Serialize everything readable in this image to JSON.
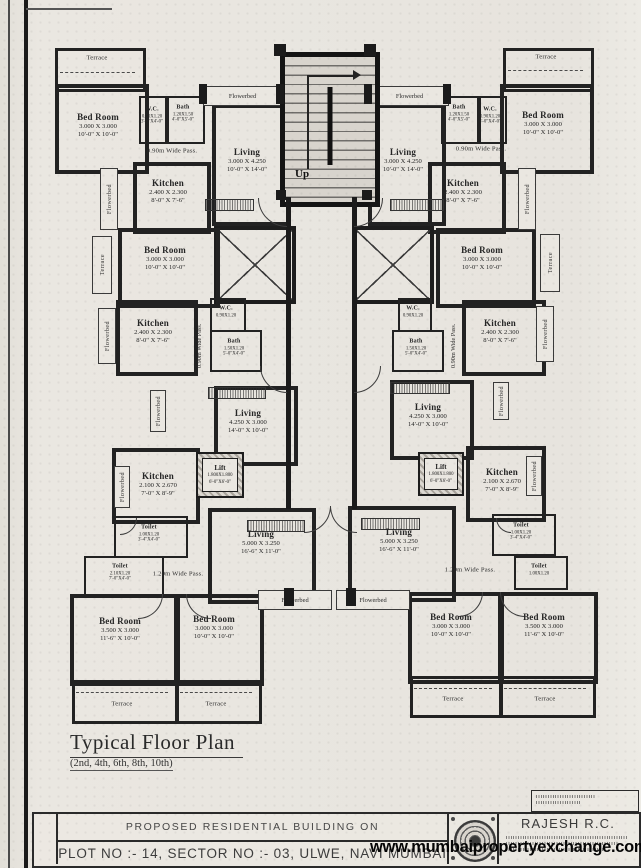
{
  "plan": {
    "title": "Typical Floor Plan",
    "subtitle": "(2nd, 4th, 6th, 8th, 10th)",
    "up": "Up",
    "labels": {
      "terrace": "Terrace",
      "flowerbed": "Flowerbed",
      "pass090": "0.90m Wide Pass.",
      "pass120": "1.20m Wide Pass."
    },
    "rooms": {
      "bed10": {
        "name": "Bed Room",
        "m": "3.000 X 3.000",
        "ft": "10'-0\" X 10'-0\""
      },
      "bed115": {
        "name": "Bed Room",
        "m": "3.500 X 3.000",
        "ft": "11'-6\" X 10'-0\""
      },
      "wc": {
        "name": "W.C.",
        "m": "0.90X1.20",
        "ft": "3'-0\"X4'-0\""
      },
      "bathTop": {
        "name": "Bath",
        "m": "1.20X1.50",
        "ft": "4'-0\"X5'-0\""
      },
      "bathMid": {
        "name": "Bath",
        "m": "1.50X1.20",
        "ft": "5'-0\"X4'-0\""
      },
      "kitchenA": {
        "name": "Kitchen",
        "m": "2.400 X 2.300",
        "ft": "8'-0\" X 7'-6\""
      },
      "kitchenB": {
        "name": "Kitchen",
        "m": "2.100 X 2.670",
        "ft": "7'-0\" X 8'-9\""
      },
      "livingTop": {
        "name": "Living",
        "m": "3.000 X 4.250",
        "ft": "10'-0\" X 14'-0\""
      },
      "livingMid": {
        "name": "Living",
        "m": "4.250 X 3.000",
        "ft": "14'-0\" X 10'-0\""
      },
      "livingBottom": {
        "name": "Living",
        "m": "5.000 X 3.250",
        "ft": "16'-6\" X 11'-0\""
      },
      "lift": {
        "name": "Lift",
        "m": "1.800X1.800",
        "ft": "6'-0\"X6'-0\""
      },
      "toiletSmall": {
        "name": "Toilet",
        "m": "1.00X1.20",
        "ft": "3'-4\"X4'-0\""
      },
      "toiletWide": {
        "name": "Toilet",
        "m": "2.10X1.20",
        "ft": "7'-0\"X4'-0\""
      }
    }
  },
  "title_block": {
    "line1": "PROPOSED RESIDENTIAL BUILDING ON",
    "line2": "PLOT NO :- 14, SECTOR NO :- 03, ULWE, NAVI MUMBAI",
    "firm": "RAJESH R.C."
  },
  "watermark": "www.mumbaipropertyexchange.com"
}
